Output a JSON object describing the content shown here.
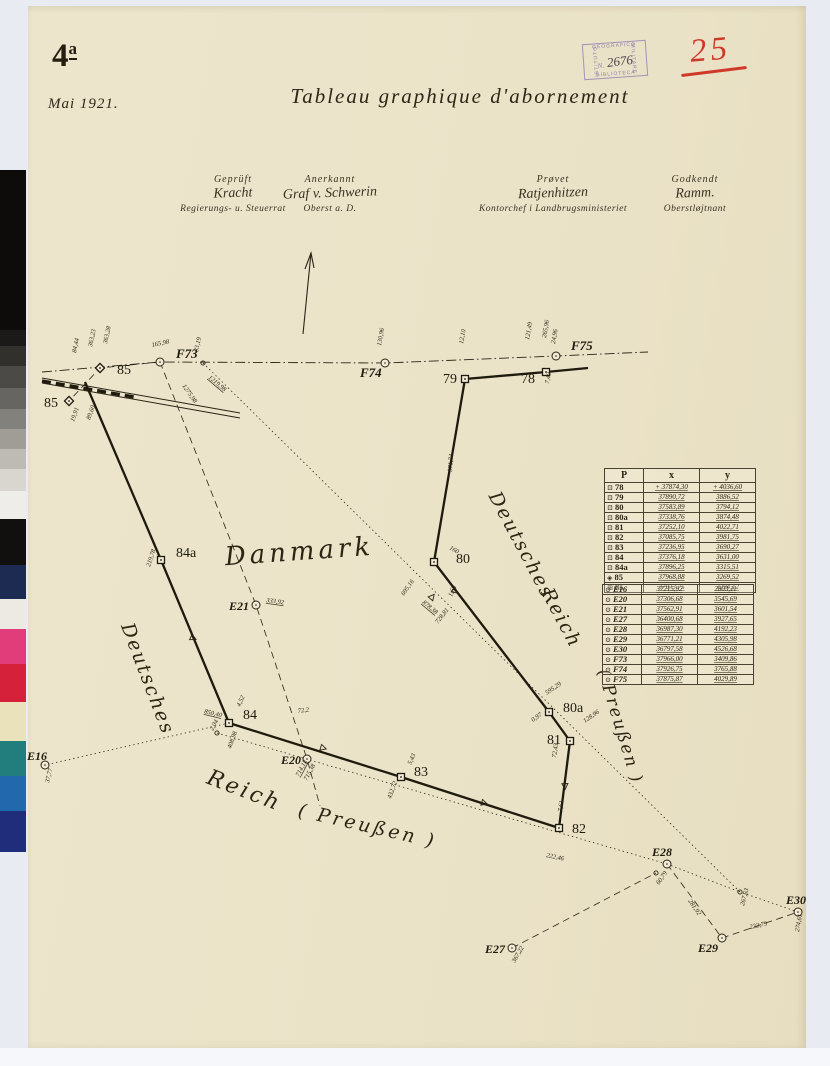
{
  "header": {
    "sheet_number": "4",
    "sheet_suffix": "a",
    "date": "Mai 1921.",
    "title": "Tableau graphique d'abornement",
    "stamp": {
      "top": "GEOGRAFICO",
      "right": "MILITARE",
      "bottom": "BIBLIOTECA",
      "left": "ISTITUTO",
      "prefix": "N.",
      "number": "2676",
      "color": "#8678b4"
    },
    "red_number": "25",
    "red_color": "#cf392a"
  },
  "signatures": [
    {
      "caption": "Geprüft",
      "name": "Kracht",
      "role": "Regierungs- u. Steuerrat"
    },
    {
      "caption": "Anerkannt",
      "name": "Graf v. Schwerin",
      "role": "Oberst a. D."
    },
    {
      "caption": "Prøvet",
      "name": "Ratjenhitzen",
      "role": "Kontorchef i Landbrugsministeriet"
    },
    {
      "caption": "Godkendt",
      "name": "Ramm.",
      "role": "Oberstløjtnant"
    }
  ],
  "tables": {
    "headers": [
      "P",
      "x",
      "y"
    ],
    "boundary_rows": [
      {
        "g": "⊡",
        "p": "78",
        "x": "+ 37874,30",
        "y": "+ 4036,60"
      },
      {
        "g": "⊡",
        "p": "79",
        "x": "37890,72",
        "y": "3886,52"
      },
      {
        "g": "⊡",
        "p": "80",
        "x": "37583,89",
        "y": "3794,12"
      },
      {
        "g": "⊡",
        "p": "80a",
        "x": "37338,76",
        "y": "3874,48"
      },
      {
        "g": "⊡",
        "p": "81",
        "x": "37252,10",
        "y": "4022,71"
      },
      {
        "g": "⊡",
        "p": "82",
        "x": "37085,75",
        "y": "3981,75"
      },
      {
        "g": "⊡",
        "p": "83",
        "x": "37236,95",
        "y": "3690,27"
      },
      {
        "g": "⊡",
        "p": "84",
        "x": "37376,18",
        "y": "3631,00"
      },
      {
        "g": "⊡",
        "p": "84a",
        "x": "37896,25",
        "y": "3315,51"
      },
      {
        "g": "◈",
        "p": "85",
        "x": "37968,88",
        "y": "3269,52"
      },
      {
        "g": "⊞",
        "p": "85",
        "x": "37973,75",
        "y": "3294,12"
      }
    ],
    "reference_rows": [
      {
        "g": "⊙",
        "p": "E16",
        "x": "37215,92",
        "y": "2803,11"
      },
      {
        "g": "⊙",
        "p": "E20",
        "x": "37306,68",
        "y": "3545,69"
      },
      {
        "g": "⊙",
        "p": "E21",
        "x": "37562,91",
        "y": "3601,54"
      },
      {
        "g": "⊙",
        "p": "E27",
        "x": "36400,68",
        "y": "3927,65"
      },
      {
        "g": "⊙",
        "p": "E28",
        "x": "36987,30",
        "y": "4192,23"
      },
      {
        "g": "⊙",
        "p": "E29",
        "x": "36771,21",
        "y": "4305,98"
      },
      {
        "g": "⊙",
        "p": "E30",
        "x": "36797,58",
        "y": "4526,68"
      },
      {
        "g": "⊙",
        "p": "F73",
        "x": "37966,00",
        "y": "3409,86"
      },
      {
        "g": "⊙",
        "p": "F74",
        "x": "37926,75",
        "y": "3765,88"
      },
      {
        "g": "⊙",
        "p": "F75",
        "x": "37875,87",
        "y": "4029,89"
      }
    ]
  },
  "map": {
    "ink": "#2b2315",
    "heavy_ink": "#1f1a0e",
    "region_labels": [
      {
        "text": "Danmark",
        "x": 300,
        "y": 560,
        "rot": -4,
        "size": 26,
        "ls": 4
      },
      {
        "text": "Deutsches",
        "x": 516,
        "y": 548,
        "rot": 62,
        "size": 19,
        "ls": 2
      },
      {
        "text": "Reich",
        "x": 556,
        "y": 621,
        "rot": 62,
        "size": 19,
        "ls": 2
      },
      {
        "text": "( Preußen )",
        "x": 615,
        "y": 728,
        "rot": 73,
        "size": 17,
        "ls": 2
      },
      {
        "text": "Deutsches",
        "x": 142,
        "y": 681,
        "rot": 69,
        "size": 19,
        "ls": 2
      },
      {
        "text": "Reich",
        "x": 242,
        "y": 797,
        "rot": 21,
        "size": 22,
        "ls": 3
      },
      {
        "text": "( Preußen )",
        "x": 366,
        "y": 832,
        "rot": 13,
        "size": 19,
        "ls": 3
      }
    ],
    "boundary_path": [
      [
        85,
        382
      ],
      [
        161,
        560
      ],
      [
        229,
        723
      ],
      [
        401,
        777
      ],
      [
        559,
        828
      ],
      [
        570,
        741
      ],
      [
        549,
        712
      ],
      [
        434,
        562
      ],
      [
        465,
        379
      ],
      [
        546,
        372
      ],
      [
        588,
        368
      ]
    ],
    "aux_lines": [
      {
        "style": "dashdot",
        "pts": [
          [
            42,
            372
          ],
          [
            160,
            362
          ],
          [
            385,
            363
          ],
          [
            556,
            356
          ],
          [
            648,
            352
          ]
        ]
      },
      {
        "style": "dashed",
        "pts": [
          [
            160,
            362
          ],
          [
            256,
            605
          ],
          [
            307,
            759
          ],
          [
            320,
            806
          ]
        ]
      },
      {
        "style": "dashed",
        "pts": [
          [
            160,
            362
          ],
          [
            100,
            368
          ],
          [
            69,
            401
          ]
        ]
      },
      {
        "style": "dotted",
        "pts": [
          [
            203,
            363
          ],
          [
            740,
            892
          ],
          [
            798,
            912
          ]
        ]
      },
      {
        "style": "dotted",
        "pts": [
          [
            229,
            723
          ],
          [
            45,
            765
          ]
        ]
      },
      {
        "style": "dotted",
        "pts": [
          [
            217,
            733
          ],
          [
            667,
            864
          ]
        ]
      },
      {
        "style": "dotted",
        "pts": [
          [
            667,
            864
          ],
          [
            740,
            892
          ]
        ]
      },
      {
        "style": "dashed",
        "pts": [
          [
            512,
            948
          ],
          [
            656,
            873
          ]
        ]
      },
      {
        "style": "dashed",
        "pts": [
          [
            667,
            864
          ],
          [
            722,
            938
          ],
          [
            798,
            912
          ]
        ]
      }
    ],
    "railway": {
      "a": [
        [
          42,
          378
        ],
        [
          240,
          413
        ]
      ],
      "b": [
        [
          42,
          383
        ],
        [
          240,
          418
        ]
      ],
      "bold": [
        [
          42,
          381
        ],
        [
          134,
          397
        ]
      ]
    },
    "north_arrow": {
      "base": [
        303,
        334
      ],
      "tip": [
        311,
        253
      ]
    },
    "points": [
      {
        "id": "85-upper",
        "m": "diamond",
        "x": 100,
        "y": 368,
        "label": "85",
        "lx": 117,
        "ly": 374,
        "fs": 14
      },
      {
        "id": "85-lower",
        "m": "diamond",
        "x": 69,
        "y": 401,
        "label": "85",
        "lx": 44,
        "ly": 407,
        "fs": 14
      },
      {
        "id": "F73",
        "m": "circle",
        "x": 160,
        "y": 362,
        "label": "F73",
        "lx": 176,
        "ly": 358,
        "it": 1,
        "fs": 13
      },
      {
        "id": "F73-aux",
        "m": "smallcircle",
        "x": 203,
        "y": 363
      },
      {
        "id": "F74",
        "m": "circle",
        "x": 385,
        "y": 363,
        "label": "F74",
        "lx": 360,
        "ly": 377,
        "it": 1,
        "fs": 13
      },
      {
        "id": "79",
        "m": "square",
        "x": 465,
        "y": 379,
        "label": "79",
        "lx": 443,
        "ly": 383,
        "fs": 14
      },
      {
        "id": "78",
        "m": "square",
        "x": 546,
        "y": 372,
        "label": "78",
        "lx": 521,
        "ly": 383,
        "fs": 14
      },
      {
        "id": "F75",
        "m": "circle",
        "x": 556,
        "y": 356,
        "label": "F75",
        "lx": 571,
        "ly": 350,
        "it": 1,
        "fs": 13
      },
      {
        "id": "80",
        "m": "square",
        "x": 434,
        "y": 562,
        "label": "80",
        "lx": 456,
        "ly": 563,
        "fs": 14
      },
      {
        "id": "80a",
        "m": "square",
        "x": 549,
        "y": 712,
        "label": "80a",
        "lx": 563,
        "ly": 712,
        "fs": 14
      },
      {
        "id": "81",
        "m": "square",
        "x": 570,
        "y": 741,
        "label": "81",
        "lx": 547,
        "ly": 744,
        "fs": 14
      },
      {
        "id": "82",
        "m": "square",
        "x": 559,
        "y": 828,
        "label": "82",
        "lx": 572,
        "ly": 833,
        "fs": 14
      },
      {
        "id": "83",
        "m": "square",
        "x": 401,
        "y": 777,
        "label": "83",
        "lx": 414,
        "ly": 776,
        "fs": 14
      },
      {
        "id": "84",
        "m": "square",
        "x": 229,
        "y": 723,
        "label": "84",
        "lx": 243,
        "ly": 719,
        "fs": 14
      },
      {
        "id": "84a",
        "m": "square",
        "x": 161,
        "y": 560,
        "label": "84a",
        "lx": 176,
        "ly": 557,
        "fs": 14
      },
      {
        "id": "84-aux",
        "m": "smallcircle",
        "x": 217,
        "y": 733
      },
      {
        "id": "E16",
        "m": "circle",
        "x": 45,
        "y": 765,
        "label": "E16",
        "lx": 27,
        "ly": 760,
        "it": 1,
        "fs": 12
      },
      {
        "id": "E20",
        "m": "circle",
        "x": 307,
        "y": 759,
        "label": "E20",
        "lx": 281,
        "ly": 764,
        "it": 1,
        "fs": 12
      },
      {
        "id": "E21",
        "m": "circle",
        "x": 256,
        "y": 605,
        "label": "E21",
        "lx": 229,
        "ly": 610,
        "it": 1,
        "fs": 12
      },
      {
        "id": "E27",
        "m": "circle",
        "x": 512,
        "y": 948,
        "label": "E27",
        "lx": 485,
        "ly": 953,
        "it": 1,
        "fs": 12
      },
      {
        "id": "E28",
        "m": "circle",
        "x": 667,
        "y": 864,
        "label": "E28",
        "lx": 652,
        "ly": 856,
        "it": 1,
        "fs": 12
      },
      {
        "id": "E28-aux",
        "m": "smallcircle",
        "x": 656,
        "y": 873
      },
      {
        "id": "E29",
        "m": "circle",
        "x": 722,
        "y": 938,
        "label": "E29",
        "lx": 698,
        "ly": 952,
        "it": 1,
        "fs": 12
      },
      {
        "id": "E29-E30-aux",
        "m": "smallcircle",
        "x": 740,
        "y": 892
      },
      {
        "id": "E30",
        "m": "circle",
        "x": 798,
        "y": 912,
        "label": "E30",
        "lx": 786,
        "ly": 904,
        "it": 1,
        "fs": 12
      }
    ],
    "ticks": [
      {
        "x": 193,
        "y": 638,
        "r": 115
      },
      {
        "x": 323,
        "y": 748,
        "r": 107
      },
      {
        "x": 455,
        "y": 591,
        "r": 128
      },
      {
        "x": 565,
        "y": 786,
        "r": 178
      },
      {
        "x": 484,
        "y": 803,
        "r": 107
      },
      {
        "x": 432,
        "y": 597,
        "r": 40
      }
    ],
    "measurements": [
      {
        "t": "84,44",
        "x": 76,
        "y": 353,
        "r": -78
      },
      {
        "t": "363,23",
        "x": 92,
        "y": 347,
        "r": -78
      },
      {
        "t": "363,28",
        "x": 107,
        "y": 344,
        "r": -78
      },
      {
        "t": "165,98",
        "x": 152,
        "y": 347,
        "r": -12
      },
      {
        "t": "33,19",
        "x": 198,
        "y": 352,
        "r": -78
      },
      {
        "t": "1275,98",
        "x": 182,
        "y": 386,
        "r": 55
      },
      {
        "t": "1219,98",
        "x": 208,
        "y": 378,
        "r": 40,
        "u": 1
      },
      {
        "t": "89,60",
        "x": 90,
        "y": 420,
        "r": -70
      },
      {
        "t": "19,91",
        "x": 74,
        "y": 422,
        "r": -70
      },
      {
        "t": "130,96",
        "x": 381,
        "y": 346,
        "r": -80
      },
      {
        "t": "12,10",
        "x": 463,
        "y": 344,
        "r": -80
      },
      {
        "t": "121,49",
        "x": 529,
        "y": 340,
        "r": -80
      },
      {
        "t": "265,96",
        "x": 546,
        "y": 338,
        "r": -80
      },
      {
        "t": "24,96",
        "x": 555,
        "y": 344,
        "r": -80
      },
      {
        "t": "7,40",
        "x": 549,
        "y": 384,
        "r": -80
      },
      {
        "t": "371,74",
        "x": 452,
        "y": 472,
        "r": -86
      },
      {
        "t": "160",
        "x": 449,
        "y": 549,
        "r": 30
      },
      {
        "t": "695,16",
        "x": 404,
        "y": 596,
        "r": -55
      },
      {
        "t": "878,38",
        "x": 422,
        "y": 603,
        "r": 40,
        "u": 1
      },
      {
        "t": "1,60",
        "x": 452,
        "y": 597,
        "r": -70
      },
      {
        "t": "728,81",
        "x": 438,
        "y": 624,
        "r": -52
      },
      {
        "t": "595,29",
        "x": 547,
        "y": 695,
        "r": -35
      },
      {
        "t": "0,97",
        "x": 533,
        "y": 722,
        "r": -35
      },
      {
        "t": "128,96",
        "x": 585,
        "y": 723,
        "r": -35
      },
      {
        "t": "72,43",
        "x": 556,
        "y": 758,
        "r": -82
      },
      {
        "t": "7,61",
        "x": 562,
        "y": 812,
        "r": -82
      },
      {
        "t": "222,46",
        "x": 546,
        "y": 857,
        "r": 12
      },
      {
        "t": "60,79",
        "x": 659,
        "y": 885,
        "r": -55
      },
      {
        "t": "281,92",
        "x": 688,
        "y": 901,
        "r": 55
      },
      {
        "t": "267,63",
        "x": 744,
        "y": 906,
        "r": -75
      },
      {
        "t": "222,79",
        "x": 750,
        "y": 929,
        "r": -12
      },
      {
        "t": "274,61",
        "x": 799,
        "y": 932,
        "r": -80
      },
      {
        "t": "367,22",
        "x": 515,
        "y": 963,
        "r": -60
      },
      {
        "t": "37,77",
        "x": 49,
        "y": 783,
        "r": -76
      },
      {
        "t": "333,92",
        "x": 266,
        "y": 602,
        "r": 8,
        "u": 1
      },
      {
        "t": "714,13",
        "x": 299,
        "y": 777,
        "r": -62,
        "u": 1
      },
      {
        "t": "715,38",
        "x": 307,
        "y": 781,
        "r": -62
      },
      {
        "t": "850,40",
        "x": 204,
        "y": 713,
        "r": 14,
        "u": 1
      },
      {
        "t": "2,04",
        "x": 213,
        "y": 731,
        "r": -62
      },
      {
        "t": "408,98",
        "x": 231,
        "y": 749,
        "r": -70
      },
      {
        "t": "4,52",
        "x": 240,
        "y": 707,
        "r": -65
      },
      {
        "t": "219,78",
        "x": 150,
        "y": 567,
        "r": -72
      },
      {
        "t": "72,2",
        "x": 298,
        "y": 713,
        "r": -8
      },
      {
        "t": "432,72",
        "x": 391,
        "y": 799,
        "r": -70
      },
      {
        "t": "5,43",
        "x": 411,
        "y": 765,
        "r": -65
      }
    ]
  },
  "calibration_strip": {
    "width": 26,
    "patches": [
      [
        "#0d0c0a",
        160
      ],
      [
        "#1b1a18",
        16
      ],
      [
        "#31302d",
        20
      ],
      [
        "#4c4a46",
        22
      ],
      [
        "#676562",
        21
      ],
      [
        "#83817b",
        20
      ],
      [
        "#a09d97",
        20
      ],
      [
        "#bebbb4",
        20
      ],
      [
        "#d9d6cf",
        22
      ],
      [
        "#efede9",
        28
      ],
      [
        "#12100e",
        46
      ],
      [
        "#1d2a52",
        34
      ],
      [
        "#eceae3",
        30
      ],
      [
        "#e03d7a",
        35
      ],
      [
        "#d52139",
        38
      ],
      [
        "#e9e2bb",
        39
      ],
      [
        "#227e7c",
        35
      ],
      [
        "#2268ad",
        35
      ],
      [
        "#202d7a",
        41
      ]
    ]
  }
}
